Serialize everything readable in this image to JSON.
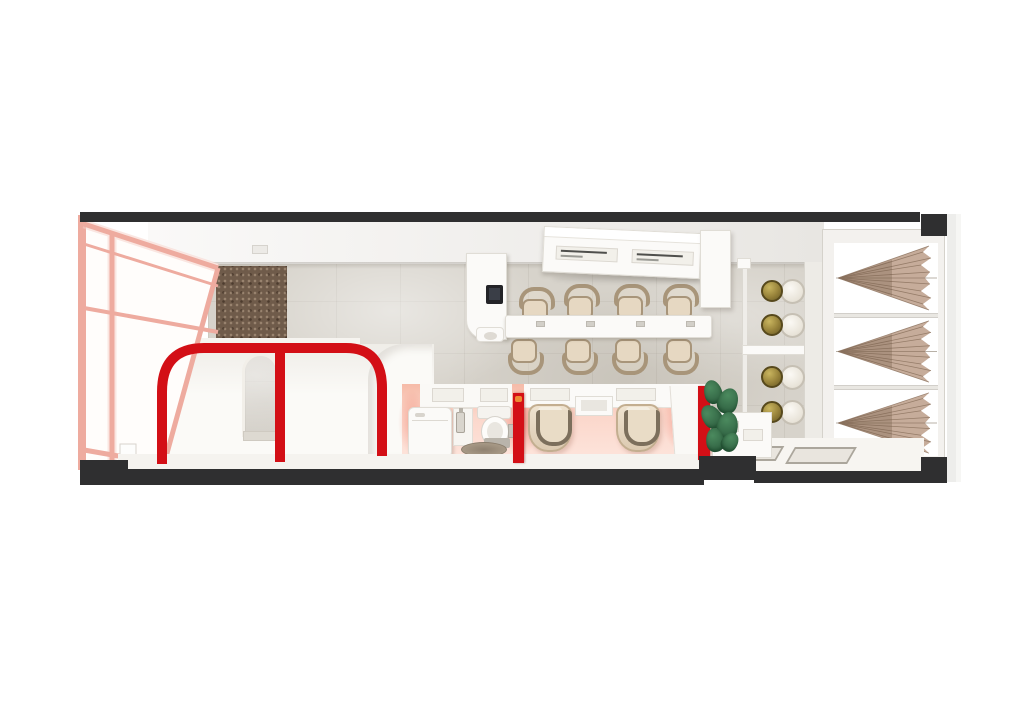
{
  "scene": {
    "subject": "nail-salon-floor-plan-top-view",
    "render_style": "3d-cutaway-render",
    "hanging_sign_panels": 2,
    "sign_text_legible": false
  },
  "colors": {
    "page": "#ffffff",
    "wall_cut": "#2f2f30",
    "accent_red": "#d30f16",
    "orange_dot": "#ee8a33",
    "window_pink": "#eeab9f",
    "window_pink_light": "#f7d0c8",
    "stone": "#d7d3cb",
    "cork": "#6f5b4a",
    "ceiling_light": "#faf9f8",
    "ceiling_dark": "#e8e6e2",
    "white_furniture": "#fbfaf8",
    "furniture_border": "#e0ddd6",
    "chair_cream": "#e6d8c2",
    "chair_trim": "#a8957a",
    "pedicure_trim": "#7c6f5c",
    "pink_floor_strong": "#f6bba8",
    "pink_floor_light": "#fde3da",
    "curtain": "#c6ac9a",
    "curtain_pleat": "#8d7460",
    "gold": "#97823a",
    "gold_light": "#c9b55f",
    "plant": "#336645",
    "mat": "#e9e5de",
    "rug": "#a89a87",
    "monitor": "#232327",
    "skirt": "#f5f3ef",
    "entry_floor": "#f7f5f1"
  },
  "counts": {
    "manicure_chairs": 8,
    "manicure_tables": 1,
    "reception_monitors": 1,
    "pedicure_chairs": 2,
    "gold_stools": 4,
    "round_seats": 4,
    "curtain_bays": 3,
    "entry_mats": 2,
    "toilets": 1,
    "plants": 1,
    "ceiling_vents": 1,
    "red_arch_openings": 2,
    "red_wall_stubs": 2
  },
  "areas": [
    "storefront-glass-wall",
    "treatment-booths",
    "reception",
    "manicure-area",
    "restroom",
    "pedicure-area",
    "lounge-stations",
    "curtained-windows",
    "entrance"
  ]
}
